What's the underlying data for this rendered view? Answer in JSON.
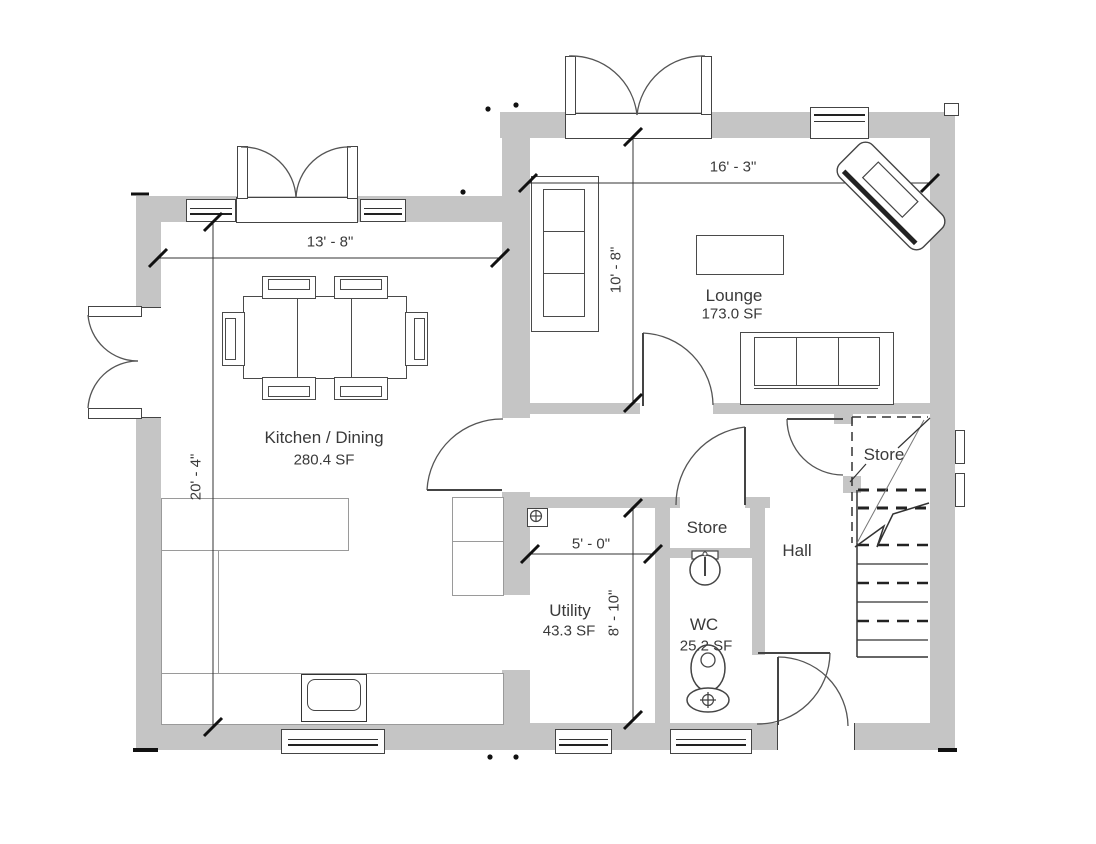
{
  "rooms": {
    "kitchen": {
      "name": "Kitchen / Dining",
      "area": "280.4 SF"
    },
    "lounge": {
      "name": "Lounge",
      "area": "173.0 SF"
    },
    "utility": {
      "name": "Utility",
      "area": "43.3 SF"
    },
    "wc": {
      "name": "WC",
      "area": "25.2 SF"
    },
    "store_closet": {
      "name": "Store"
    },
    "store_stairs": {
      "name": "Store"
    },
    "hall": {
      "name": "Hall"
    }
  },
  "dimensions": {
    "kitchen_width": "13' - 8\"",
    "kitchen_depth": "20' - 4\"",
    "lounge_width": "16' - 3\"",
    "lounge_depth": "10' - 8\"",
    "utility_width": "5' - 0\"",
    "utility_depth": "8' - 10\""
  },
  "colors": {
    "wall": "#c5c5c5",
    "linework": "#444444",
    "text": "#3a3a3a"
  }
}
